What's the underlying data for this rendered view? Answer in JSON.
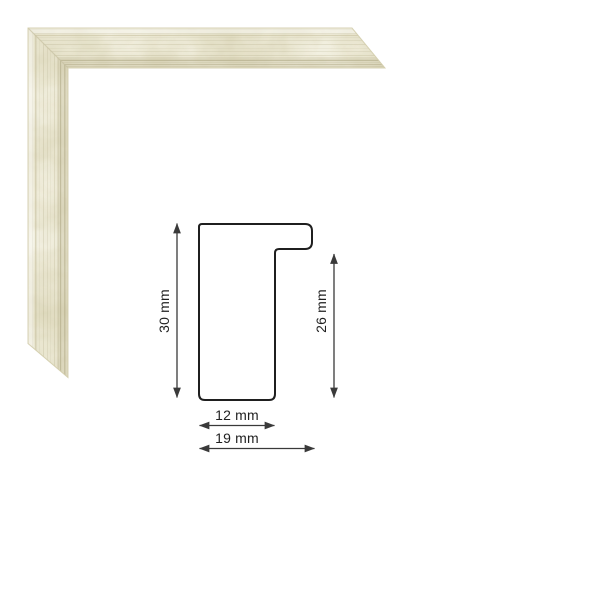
{
  "canvas": {
    "background_color": "#ffffff"
  },
  "frame_sample": {
    "base_color": "#e2ddc2",
    "highlight_color": "#f7f5e8",
    "shadow_color": "#cdc7a3",
    "stripe_color": "#a8a17c",
    "band_color": "#bdb694",
    "bevel_line_color": "#c6bf9e",
    "seam_color": "#c6c0a0",
    "edge_color": "#d3cdac",
    "bevel_highlight_color": "#ffffff"
  },
  "diagram": {
    "outline_color": "#1f1f1f",
    "dimension_color": "#3a3a3a",
    "label_color": "#1f1f1f",
    "labels": {
      "total_height": "30 mm",
      "rebate_height": "26 mm",
      "face_width": "12 mm",
      "total_width": "19 mm"
    }
  }
}
